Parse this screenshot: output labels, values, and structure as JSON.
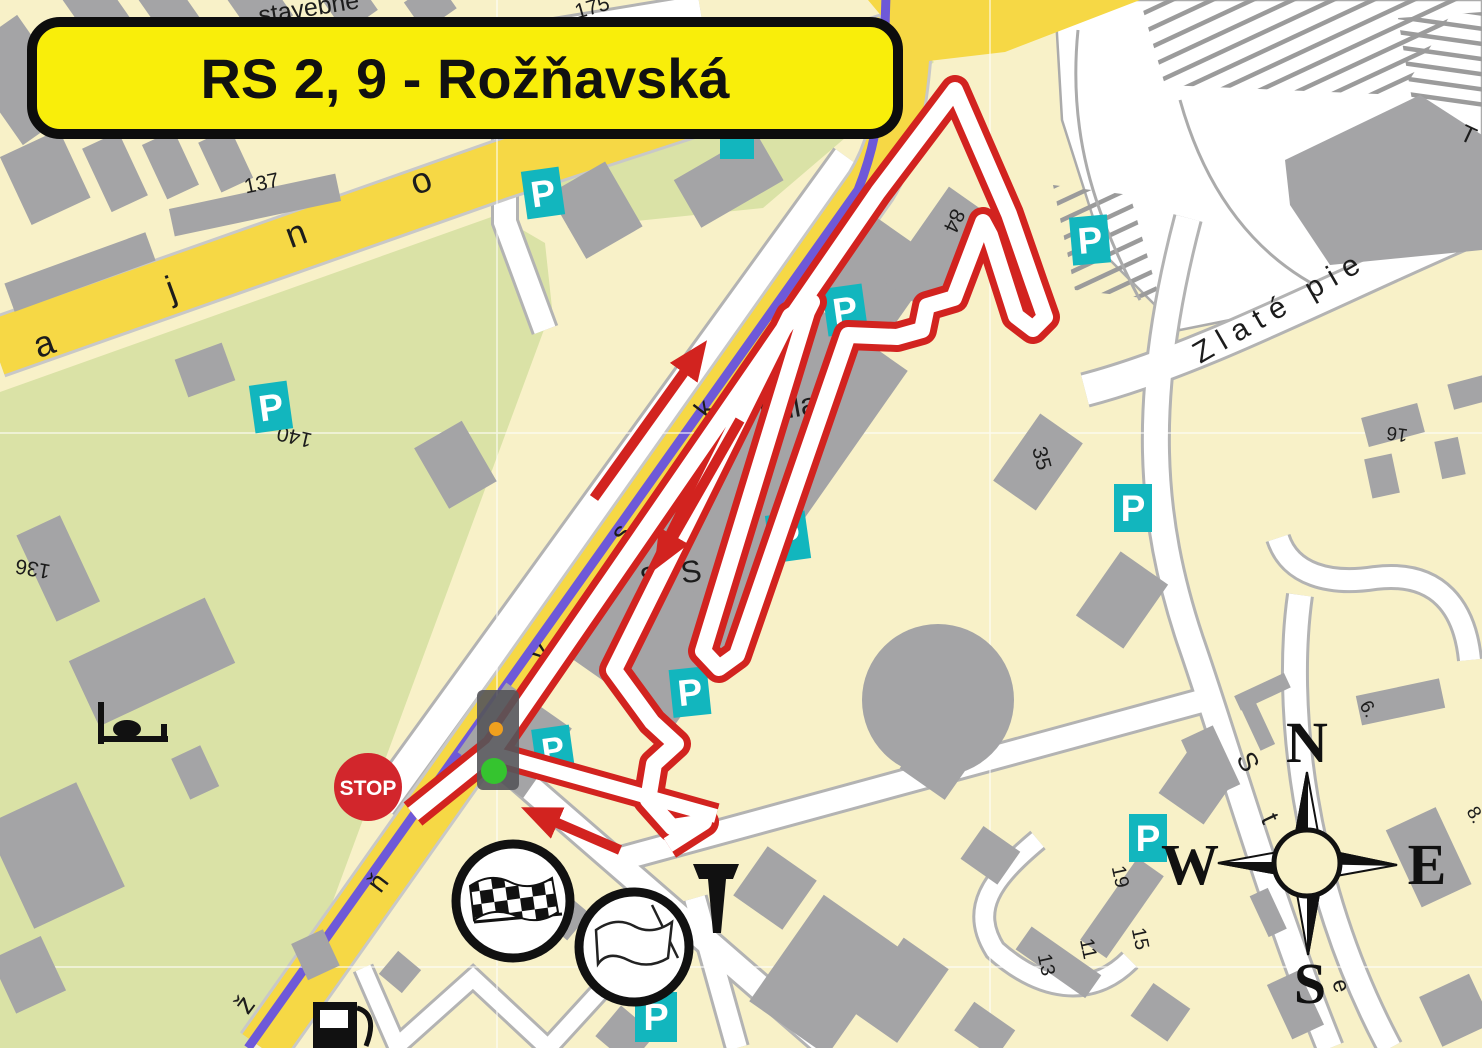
{
  "title": "RS 2, 9 - Rožňavská",
  "stop_label": "STOP",
  "parking_label": "P",
  "compass": {
    "north": "N",
    "south": "S",
    "west": "W",
    "east": "E"
  },
  "place_labels": {
    "billa": "Billa",
    "sps": "SPS",
    "zlate_piesky": "Zlaté pie",
    "t_partial": "T",
    "stavebne": "stavebné"
  },
  "house_numbers": {
    "n175": "175",
    "n137": "137",
    "n140": "140",
    "n136": "136",
    "n84": "84",
    "n35": "35",
    "n16": "16",
    "n19": "19",
    "n15": "15",
    "n13": "13",
    "n11": "11",
    "n6": "6.",
    "n8": "8."
  },
  "street_letters": {
    "top_road": [
      "a",
      "j",
      "n",
      "o"
    ],
    "roznavska": [
      "ž",
      "ň",
      "v",
      "s",
      "k"
    ],
    "studena": [
      "S",
      "t",
      "u",
      "e"
    ]
  },
  "icons": {
    "finish_flag": "checkered-flag",
    "start_flag": "white-flag",
    "stop_sign": "stop-sign",
    "traffic_light": "traffic-light",
    "fuel_station": "fuel-pump",
    "hotel": "bed",
    "monument": "monument",
    "compass_rose": "compass-rose"
  },
  "colors": {
    "route_red": "#D2231F",
    "map_cream": "#F8F1C8",
    "map_green": "#DAE2A6",
    "building_gray": "#A4A4A6",
    "road_yellow": "#F6D845",
    "tram_blue": "#6E59D8",
    "parking_teal": "#12B6BE",
    "banner_yellow": "#F9EE0A",
    "stop_red": "#D2262C"
  }
}
